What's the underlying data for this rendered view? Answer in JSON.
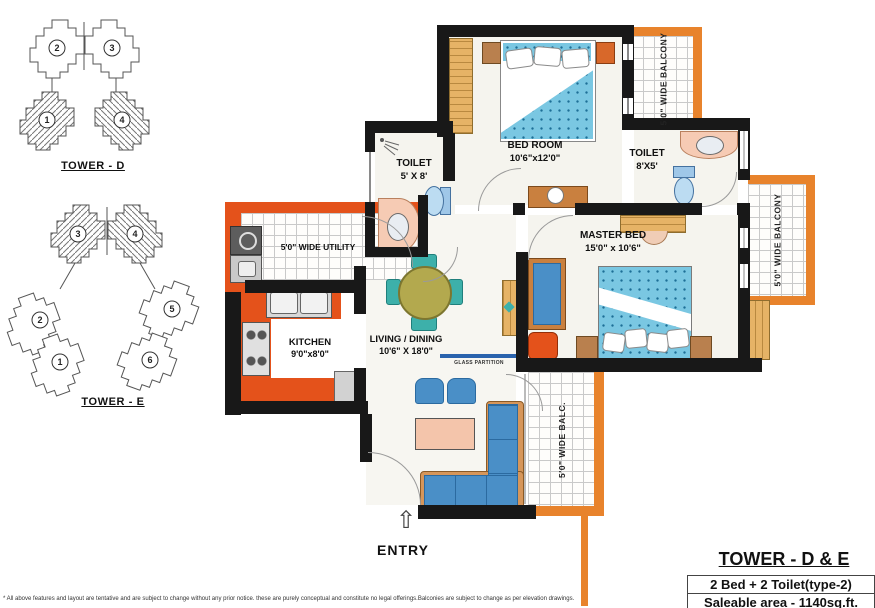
{
  "colors": {
    "wall": "#181818",
    "orange_wall": "#e4521b",
    "balcony_orange": "#e8832c",
    "wood": "#e6b366",
    "sofa_blue": "#4a8fc7",
    "bed_blue": "#7ac7e2",
    "teal": "#3db0aa",
    "olive": "#b3a94e",
    "peach": "#f6cbb4",
    "partition_blue": "#2a63ad"
  },
  "key_plans": {
    "tower_d": {
      "label": "TOWER - D",
      "units": [
        {
          "num": "2"
        },
        {
          "num": "3"
        },
        {
          "num": "1"
        },
        {
          "num": "4"
        }
      ]
    },
    "tower_e": {
      "label": "TOWER - E",
      "units": [
        {
          "num": "3"
        },
        {
          "num": "4"
        },
        {
          "num": "2"
        },
        {
          "num": "1"
        },
        {
          "num": "5"
        },
        {
          "num": "6"
        }
      ]
    }
  },
  "plan": {
    "bedroom": {
      "name": "BED ROOM",
      "dims": "10'6\"x12'0\""
    },
    "toilet_small": {
      "name": "TOILET",
      "dims": "5' X 8'"
    },
    "toilet_master": {
      "name": "TOILET",
      "dims": "8'X5'"
    },
    "master_bed": {
      "name": "MASTER BED",
      "dims": "15'0\" x 10'6\""
    },
    "kitchen": {
      "name": "KITCHEN",
      "dims": "9'0\"x8'0\""
    },
    "living": {
      "name": "LIVING / DINING",
      "dims": "10'6\" X 18'0\""
    },
    "utility": {
      "label": "5'0\" WIDE UTILITY"
    },
    "balcony_top_right": {
      "label": "5'0\" WIDE BALCONY"
    },
    "balcony_right": {
      "label": "5'0\" WIDE BALCONY"
    },
    "balcony_bottom": {
      "label": "5'0\" WIDE BALC."
    },
    "glass_partition_label": "GLASS PARTITION",
    "entry_label": "ENTRY"
  },
  "icons": {
    "entry_arrow": "⇧"
  },
  "title_block": {
    "title": "TOWER - D & E",
    "line1": "2 Bed + 2 Toilet(type-2)",
    "line2": "Saleable area - 1140sq.ft."
  },
  "disclaimer": "* All above features and layout are tentative and are subject to change without any prior notice. these are purely conceptual and constitute no legal offerings.Balconies are subject to change as per elevation drawings."
}
